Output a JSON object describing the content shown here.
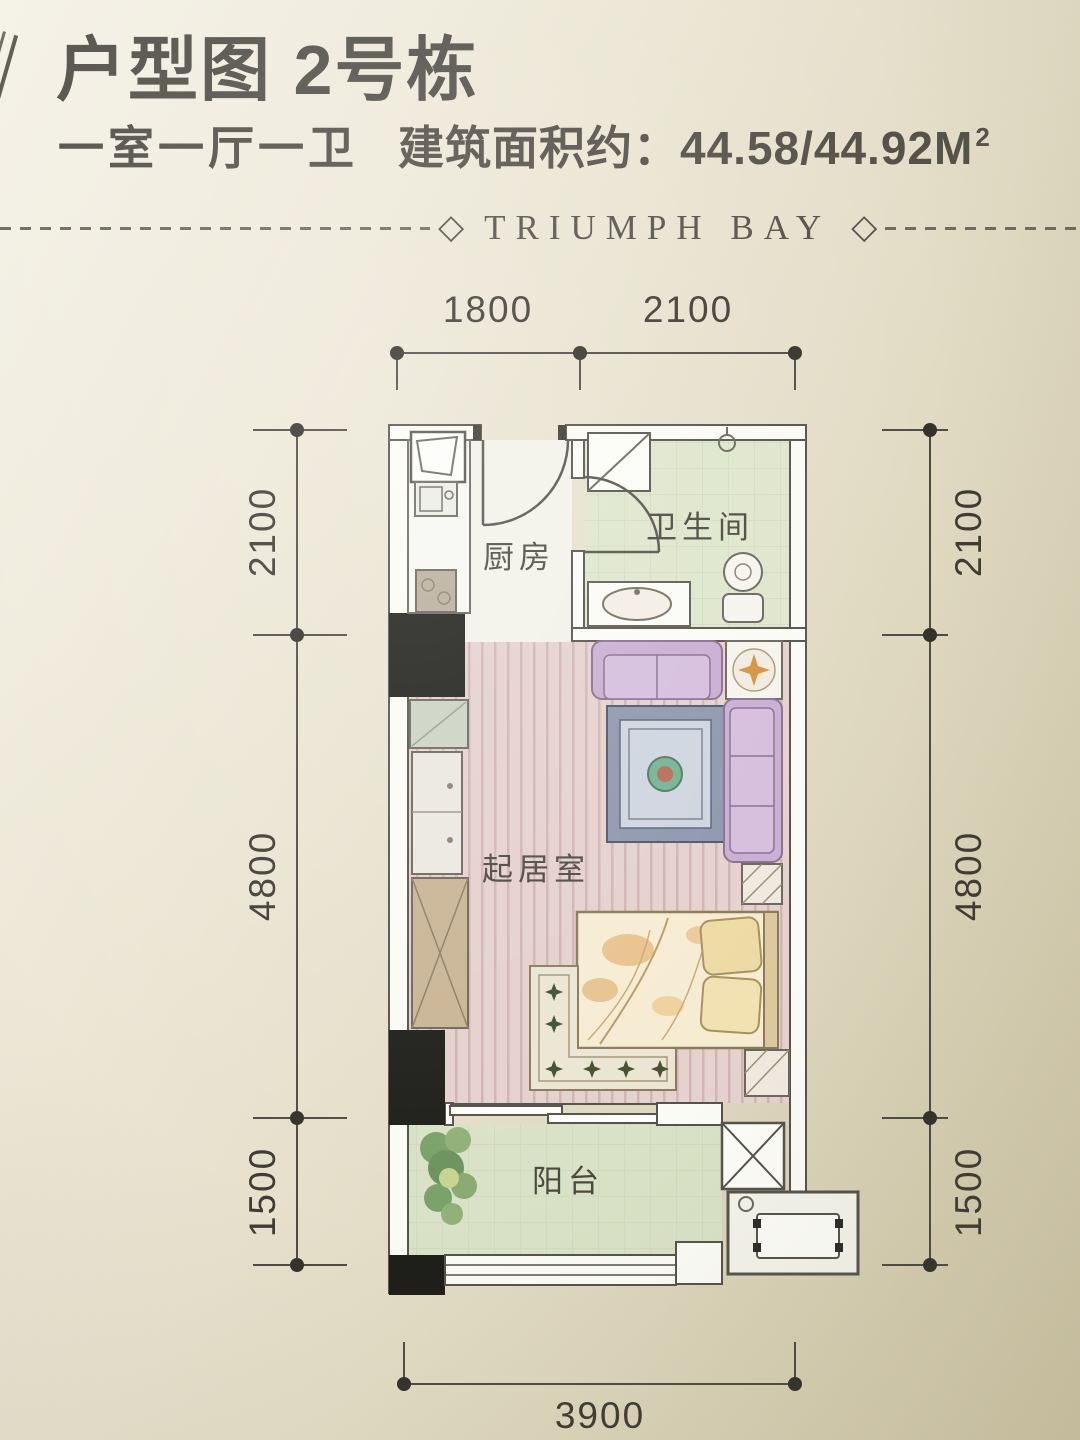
{
  "header": {
    "title": "户型图 2号栋",
    "subtitle_rooms": "一室一厅一卫",
    "subtitle_area_label": "建筑面积约：",
    "subtitle_area_value": "44.58/44.92",
    "subtitle_area_unit": "M",
    "subtitle_area_exponent": "2",
    "brand": "TRIUMPH BAY",
    "diamond": "◇"
  },
  "plan": {
    "rooms": {
      "kitchen": "厨房",
      "bathroom": "卫生间",
      "living_room": "起居室",
      "balcony": "阳台"
    },
    "dimensions": {
      "top": [
        "1800",
        "2100"
      ],
      "bottom": [
        "3900"
      ],
      "left": [
        "2100",
        "4800",
        "1500"
      ],
      "right": [
        "2100",
        "4800",
        "1500"
      ]
    }
  },
  "colors": {
    "paper": "#e9e4d0",
    "ink": "#3e3c34",
    "wall_fill": "#fbfbf6",
    "wall_outline": "#55534b",
    "column": "#1e1e1a",
    "kitchen_floor": "#f2f2ea",
    "bathroom_floor": "#dfe6cc",
    "living_floor": "#e5d1cd",
    "balcony_floor": "#d9e1c6",
    "sofa": "#c9aed3",
    "rug_border": "#8e97ae",
    "bed": "#f6ecd2",
    "accent_orange": "#d8913f"
  }
}
